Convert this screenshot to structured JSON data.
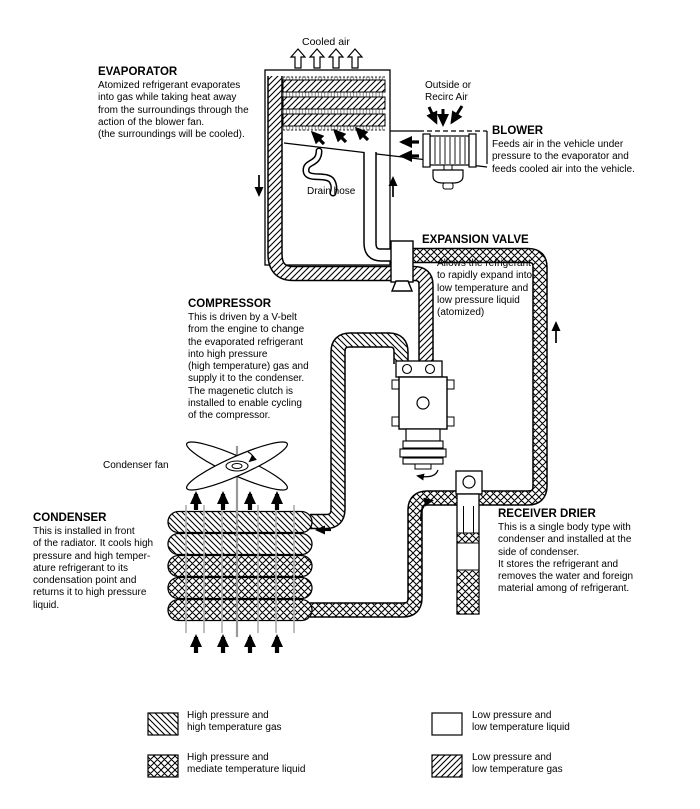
{
  "labels": {
    "cooled_air": "Cooled air",
    "outside_air": "Outside or\nRecirc Air",
    "drain_hose": "Drain hose",
    "condenser_fan": "Condenser fan"
  },
  "components": {
    "evaporator": {
      "heading": "EVAPORATOR",
      "description": "Atomized refrigerant evaporates\ninto gas while taking heat away\nfrom the surroundings through the\naction of the blower fan.\n(the surroundings will be cooled)."
    },
    "blower": {
      "heading": "BLOWER",
      "description": "Feeds air in the vehicle under\npressure to the evaporator and\nfeeds cooled air into the vehicle."
    },
    "expansion_valve": {
      "heading": "EXPANSION VALVE",
      "description": "Allows the refrigerant\nto rapidly expand into\nlow temperature and\nlow pressure liquid\n(atomized)"
    },
    "compressor": {
      "heading": "COMPRESSOR",
      "description": "This is driven by a V-belt\nfrom the engine to change\nthe evaporated refrigerant\ninto high pressure\n(high temperature) gas and\nsupply it to the condenser.\nThe magenetic clutch is\ninstalled to enable cycling\nof the compressor."
    },
    "condenser": {
      "heading": "CONDENSER",
      "description": "This is installed in front\nof the radiator. It cools high\npressure and high temper-\nature refrigerant to its\ncondensation point and\nreturns it to high pressure\nliquid."
    },
    "receiver_drier": {
      "heading": "RECEIVER DRIER",
      "description": "This is a single body type with\ncondenser and installed at the\nside of condenser.\nIt stores the refrigerant and\nremoves the water and foreign\nmaterial among of refrigerant."
    }
  },
  "legend": {
    "items": [
      {
        "pattern": "diagonal-back",
        "label": "High pressure and\nhigh temperature gas"
      },
      {
        "pattern": "cross-hatch",
        "label": "High pressure and\nmediate temperature liquid"
      },
      {
        "pattern": "none",
        "label": "Low pressure and\nlow temperature liquid"
      },
      {
        "pattern": "diagonal-forward",
        "label": "Low pressure and\nlow temperature gas"
      }
    ]
  },
  "colors": {
    "line": "#000000",
    "fin_gray": "#b0b0b0",
    "background": "#ffffff"
  }
}
